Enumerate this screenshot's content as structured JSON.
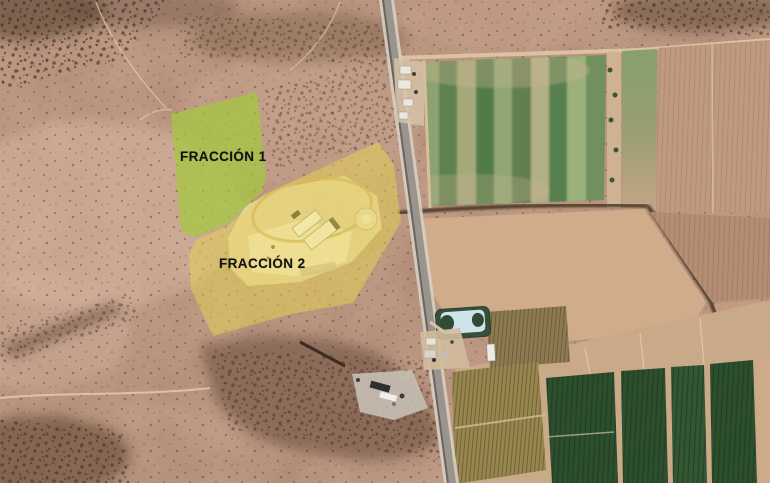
{
  "view": {
    "type": "satellite-imagery",
    "description": "Aerial view of two land parcels beside a highway with desert terrain and farm fields"
  },
  "annotations": {
    "parcel_1_label": "FRACCIÓN 1",
    "parcel_2_label": "FRACCIÓN 2"
  },
  "colors": {
    "desert-base": "#c6a28d",
    "parcel-green": "#a3c93e",
    "parcel-yellow": "#e8d44f",
    "field-green-dark": "#2d4f2e",
    "crop-green": "#6f9159",
    "pond-water": "#cfe4ea",
    "pond-edge": "#36503b",
    "road-asphalt": "#9a948d",
    "road-shoulder": "#d7cfc3",
    "label-text": "#111111"
  }
}
